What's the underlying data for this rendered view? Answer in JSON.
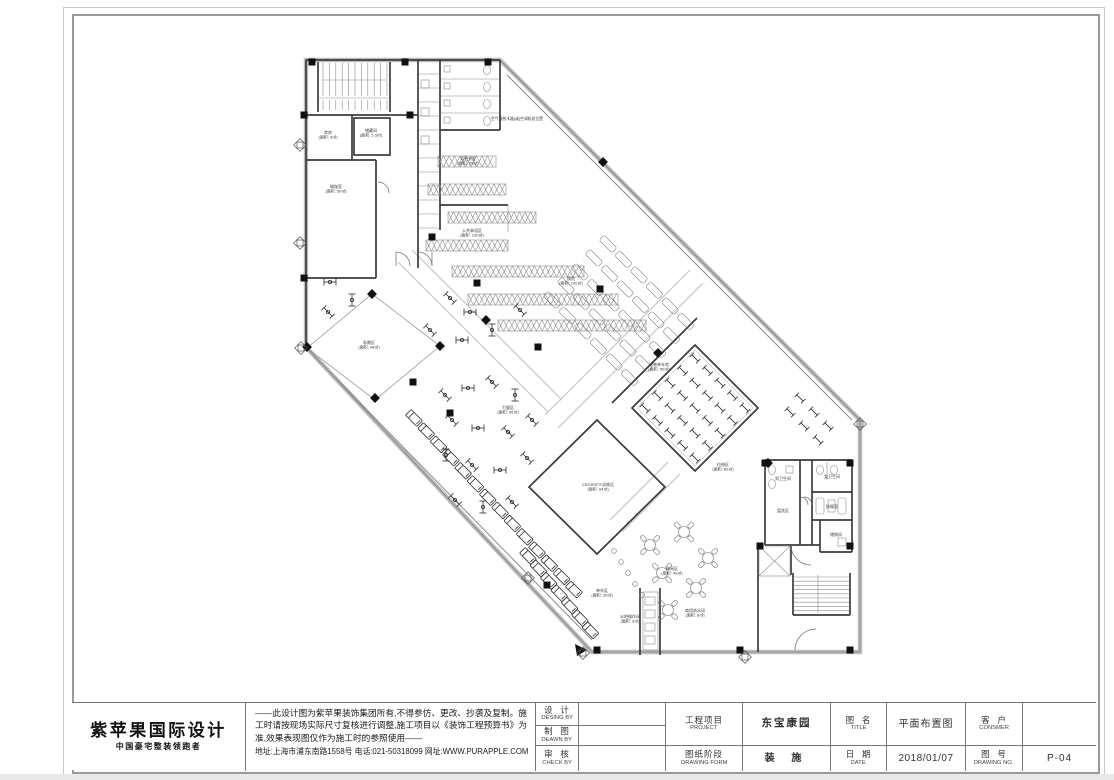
{
  "logo": {
    "name": "紫苹果国际设计",
    "tagline": "中国豪宅整装领跑者"
  },
  "disclaimer": {
    "text": "——此设计图为紫苹果装饰集团所有,不得参仿、更改、抄袭及复制。施工时请按现场实际尺寸复核进行调整,施工项目以《装饰工程预算书》为准,效果表现图仅作为施工时的参照使用——",
    "contact": "地址:上海市浦东南路1558号   电话:021-50318099  网址:WWW.PURAPPLE.COM"
  },
  "title_block": {
    "design_by_cn": "设  计",
    "design_by_en": "DESING BY",
    "design_by_value": "",
    "drawn_by_cn": "制  图",
    "drawn_by_en": "DEAWN  BY",
    "drawn_by_value": "",
    "check_by_cn": "审  核",
    "check_by_en": "CHECK  BY",
    "check_by_value": "",
    "project_cn": "工程项目",
    "project_en": "PROJECT",
    "project_value": "东宝康园",
    "form_cn": "图纸阶段",
    "form_en": "DRAWING FORM",
    "form_value": "装 施",
    "title_cn": "图  名",
    "title_en": "TITLE",
    "title_value": "平面布置图",
    "date_cn": "日  期",
    "date_en": "DATE",
    "date_value": "2018/01/07",
    "consumer_cn": "客  户",
    "consumer_en": "CONSMER",
    "consumer_value": "",
    "no_cn": "图  号",
    "no_en": "DRAWING NO.",
    "no_value": "P-04"
  },
  "floor_plan": {
    "annotation": {
      "text": "空气源热水器(或)空调机组位置",
      "x": 517,
      "y": 120
    },
    "room_labels": [
      {
        "lines": [
          "库房",
          "(面积: 9㎡)"
        ],
        "x": 328,
        "y": 134
      },
      {
        "lines": [
          "储藏间",
          "(面积: 5.3㎡)"
        ],
        "x": 371,
        "y": 132
      },
      {
        "lines": [
          "瑜伽室",
          "(面积: 50㎡)"
        ],
        "x": 336,
        "y": 188
      },
      {
        "lines": [
          "男更衣室",
          "(面积: 35㎡)"
        ],
        "x": 468,
        "y": 160
      },
      {
        "lines": [
          "公共淋浴区",
          "(面积: 100㎡)"
        ],
        "x": 472,
        "y": 232
      },
      {
        "lines": [
          "操房",
          "(面积: 100㎡)"
        ],
        "x": 571,
        "y": 280
      },
      {
        "lines": [
          "私教区",
          "(面积: 48㎡)"
        ],
        "x": 369,
        "y": 344
      },
      {
        "lines": [
          "力量区",
          "(面积: 96㎡)"
        ],
        "x": 508,
        "y": 409
      },
      {
        "lines": [
          "动感单车房",
          "(面积: 50㎡)"
        ],
        "x": 659,
        "y": 366
      },
      {
        "lines": [
          "拉伸区",
          "(面积: 60㎡)"
        ],
        "x": 723,
        "y": 466
      },
      {
        "lines": [
          "CROSSFIT训练区",
          "(面积: 94㎡)"
        ],
        "x": 598,
        "y": 486
      },
      {
        "lines": [
          "单车区",
          "(面积: 30㎡)"
        ],
        "x": 602,
        "y": 592
      },
      {
        "lines": [
          "休闲区",
          "(面积: 40㎡)"
        ],
        "x": 672,
        "y": 570
      },
      {
        "lines": [
          "水吧操作间",
          "(面积: 9㎡)"
        ],
        "x": 630,
        "y": 618
      },
      {
        "lines": [
          "商用热水间",
          "(面积: 8㎡)"
        ],
        "x": 695,
        "y": 612
      },
      {
        "lines": [
          "男卫生间"
        ],
        "x": 783,
        "y": 480
      },
      {
        "lines": [
          "盥洗区"
        ],
        "x": 783,
        "y": 512
      },
      {
        "lines": [
          "女卫生间"
        ],
        "x": 832,
        "y": 478
      },
      {
        "lines": [
          "按摩室"
        ],
        "x": 832,
        "y": 508
      },
      {
        "lines": [
          "储物间"
        ],
        "x": 836,
        "y": 536
      }
    ]
  }
}
